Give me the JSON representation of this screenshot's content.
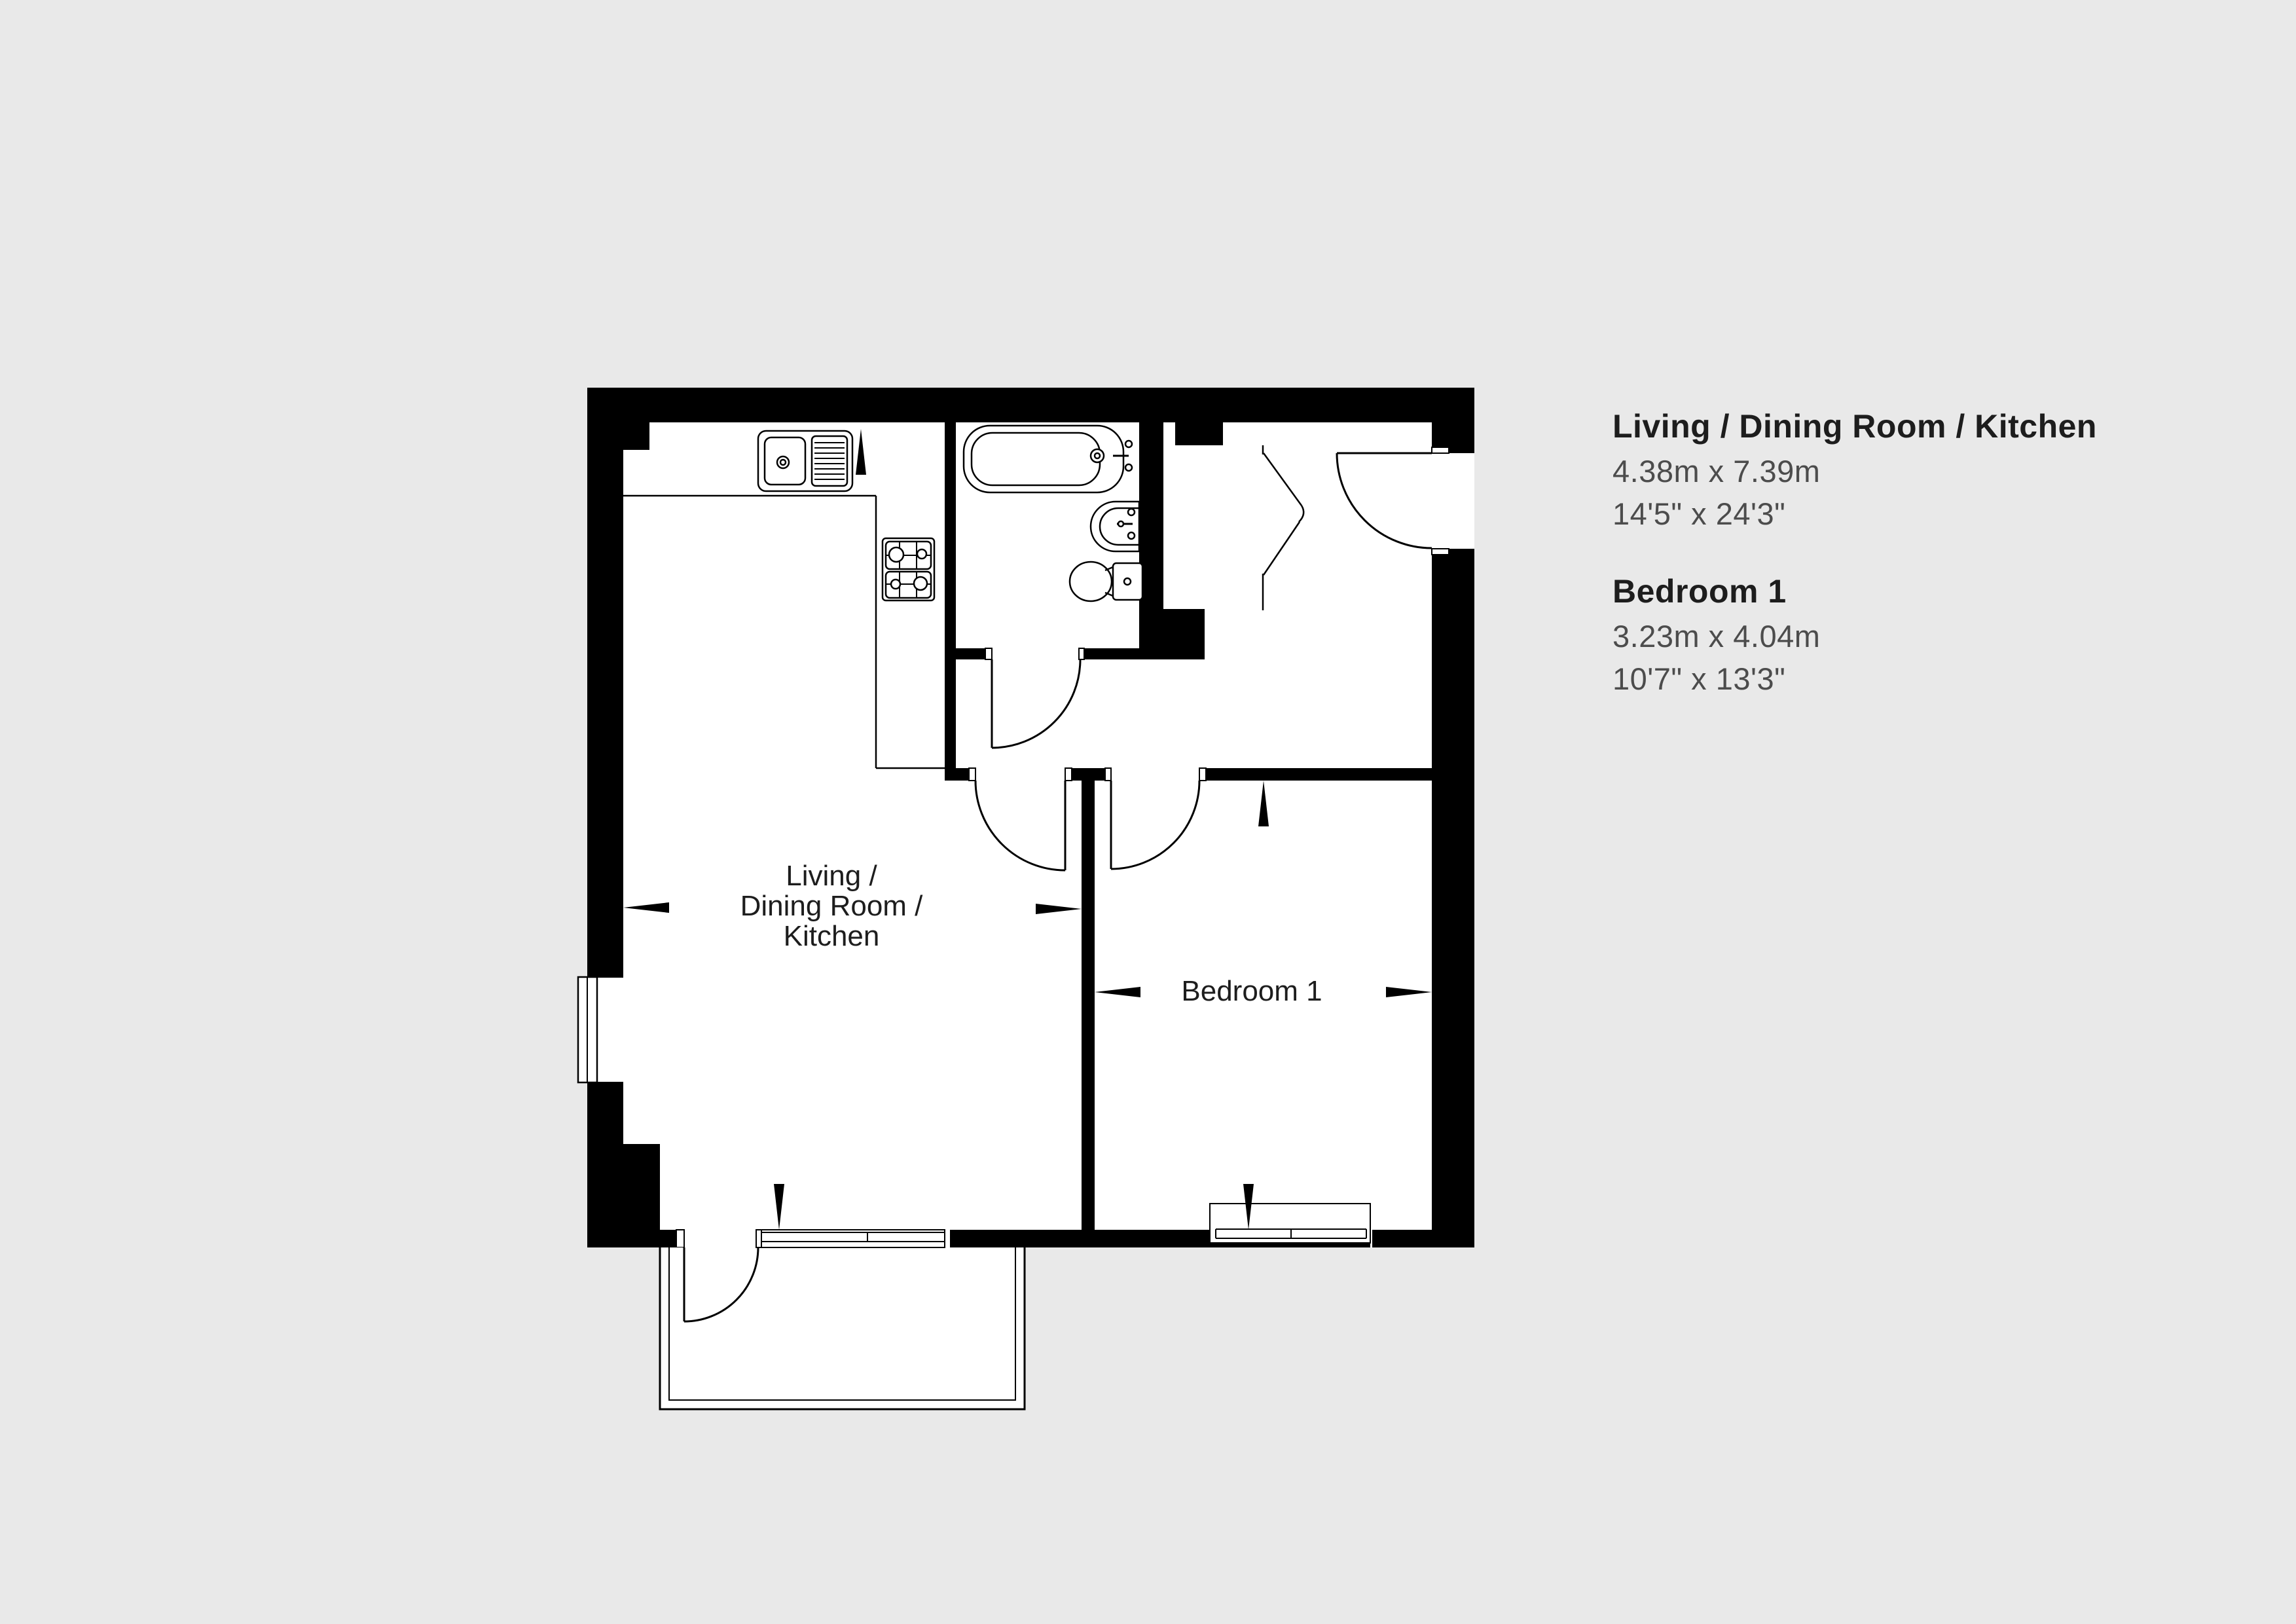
{
  "colors": {
    "background": "#e9e9e9",
    "wall": "#000000",
    "floor": "#ffffff",
    "line": "#000000",
    "title_text": "#1d1d1d",
    "dim_text": "#4c4c4c"
  },
  "info_panel": {
    "rooms": [
      {
        "name": "Living / Dining Room / Kitchen",
        "metric": "4.38m x 7.39m",
        "imperial": "14'5\" x 24'3\""
      },
      {
        "name": "Bedroom 1",
        "metric": "3.23m x 4.04m",
        "imperial": "10'7\" x 13'3\""
      }
    ]
  },
  "plan": {
    "living_label": {
      "line1": "Living /",
      "line2": "Dining Room /",
      "line3": "Kitchen"
    },
    "bedroom_label": "Bedroom 1",
    "fixtures": [
      "kitchen-sink",
      "hob",
      "bathtub",
      "basin",
      "toilet",
      "balcony",
      "entry-door",
      "cupboard-doors"
    ],
    "dimension_arrow_count": 8
  }
}
